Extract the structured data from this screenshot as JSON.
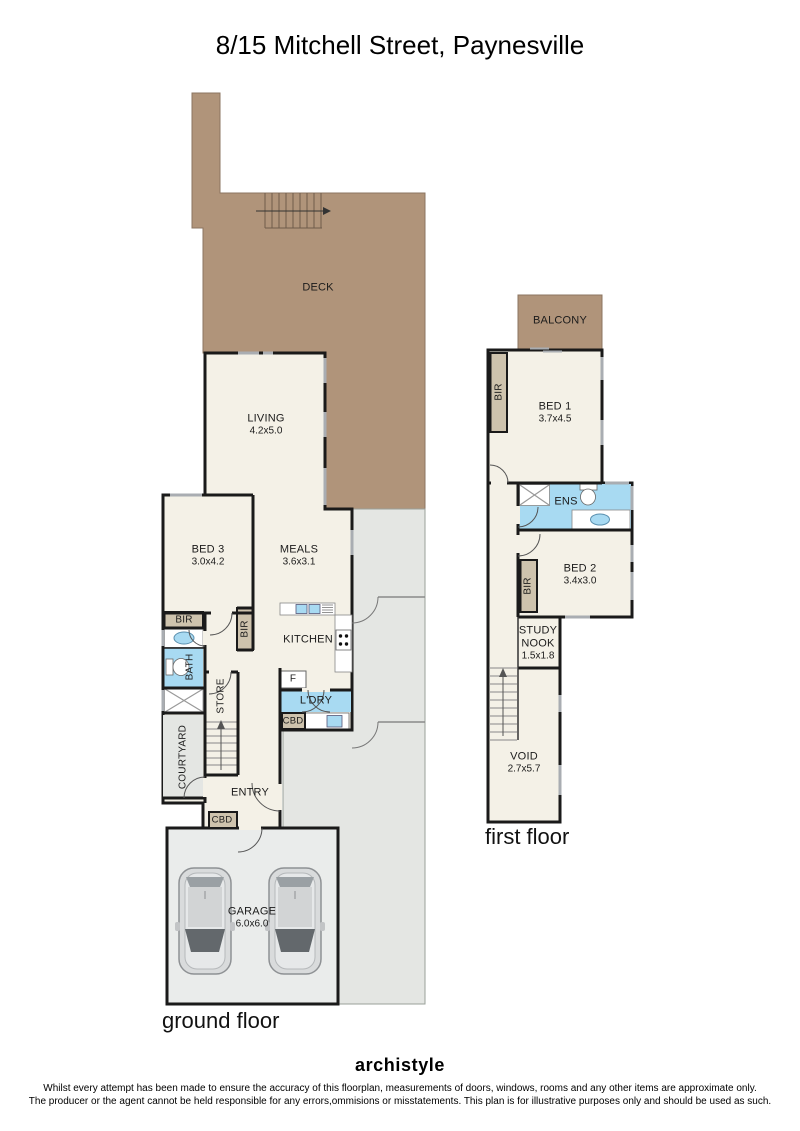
{
  "title": "8/15 Mitchell Street, Paynesville",
  "colors": {
    "deck": "#b0947a",
    "wet_area": "#a8daf2",
    "storage": "#cec3ad",
    "outdoor": "#e4e6e3",
    "floor": "#f4f1e7",
    "garage_floor": "#eaeceb",
    "wall": "#1a1a1a",
    "window": "#a9adb2"
  },
  "ground_floor": {
    "label": "ground floor",
    "deck": "DECK",
    "living": {
      "name": "LIVING",
      "dims": "4.2x5.0"
    },
    "bed3": {
      "name": "BED 3",
      "dims": "3.0x4.2"
    },
    "meals": {
      "name": "MEALS",
      "dims": "3.6x3.1"
    },
    "kitchen": "KITCHEN",
    "fridge": "F",
    "laundry": "L'DRY",
    "laundry_cupboard": "CBD",
    "entry": "ENTRY",
    "entry_cupboard": "CBD",
    "robe1": "BIR",
    "robe2": "BIR",
    "bath": "BATH",
    "store": "STORE",
    "courtyard": "COURTYARD",
    "garage": {
      "name": "GARAGE",
      "dims": "6.0x6.0"
    }
  },
  "first_floor": {
    "label": "first floor",
    "balcony": "BALCONY",
    "bed1": {
      "name": "BED 1",
      "dims": "3.7x4.5"
    },
    "bed1_robe": "BIR",
    "ensuite": "ENS",
    "bed2": {
      "name": "BED 2",
      "dims": "3.4x3.0"
    },
    "bed2_robe": "BIR",
    "study_nook": {
      "line1": "STUDY",
      "line2": "NOOK",
      "dims": "1.5x1.8"
    },
    "void": {
      "name": "VOID",
      "dims": "2.7x5.7"
    }
  },
  "footer": {
    "logo": "archistyle",
    "disclaimer_line1": "Whilst every attempt has been made to ensure the accuracy of this floorplan, measurements of doors, windows, rooms and any other items are approximate only.",
    "disclaimer_line2": "The producer or the agent cannot be held responsible for any errors,ommisions or misstatements. This plan is for illustrative purposes only and should be used as such."
  }
}
